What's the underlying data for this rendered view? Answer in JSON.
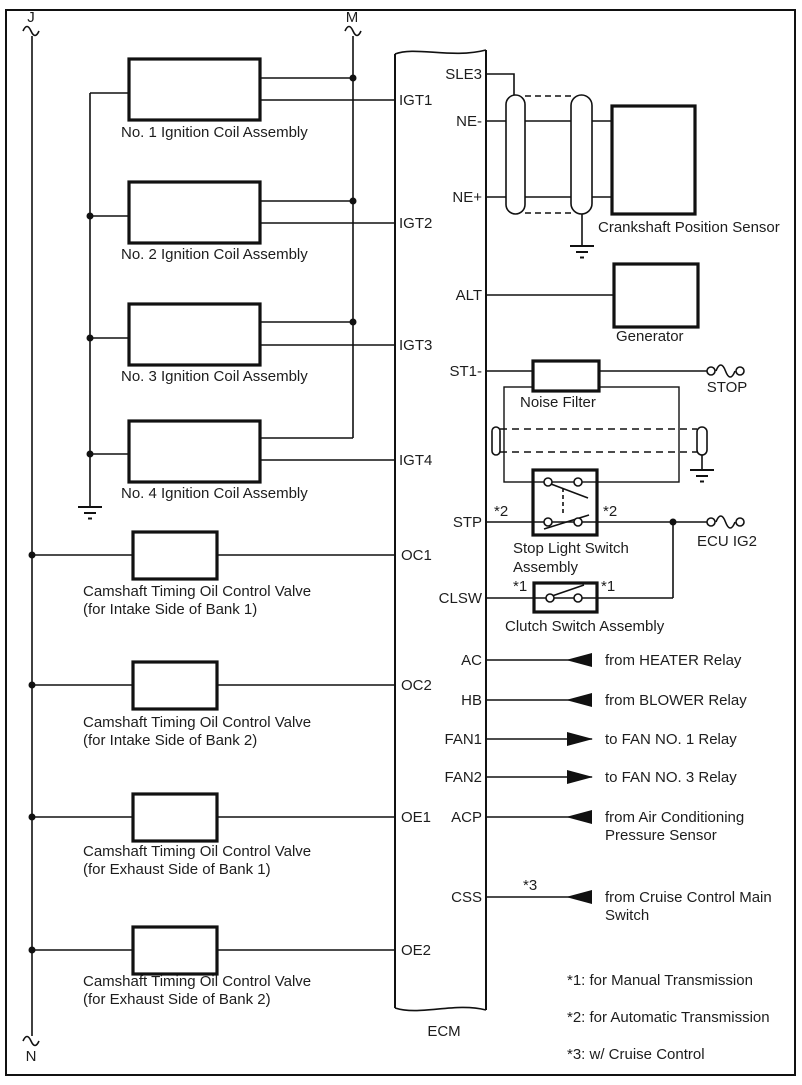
{
  "connectors": {
    "j": "J",
    "m": "M",
    "n": "N",
    "stop": "STOP",
    "ecu_ig2": "ECU IG2"
  },
  "ecm": {
    "label": "ECM",
    "right_pins": {
      "sle3": "SLE3",
      "ne_minus": "NE-",
      "ne_plus": "NE+",
      "alt": "ALT",
      "st1_minus": "ST1-",
      "stp": "STP",
      "clsw": "CLSW",
      "ac": "AC",
      "hb": "HB",
      "fan1": "FAN1",
      "fan2": "FAN2",
      "acp": "ACP",
      "css": "CSS"
    },
    "left_pins": {
      "igt1": "IGT1",
      "igt2": "IGT2",
      "igt3": "IGT3",
      "igt4": "IGT4",
      "oc1": "OC1",
      "oc2": "OC2",
      "oe1": "OE1",
      "oe2": "OE2"
    }
  },
  "devices": {
    "coil1": "No. 1 Ignition Coil Assembly",
    "coil2": "No. 2 Ignition Coil Assembly",
    "coil3": "No. 3 Ignition Coil Assembly",
    "coil4": "No. 4 Ignition Coil Assembly",
    "valve_line1": "Camshaft Timing Oil Control Valve",
    "valve1_line2": "(for Intake Side of Bank 1)",
    "valve2_line2": "(for Intake Side of Bank 2)",
    "valve3_line2": "(for Exhaust Side of Bank 1)",
    "valve4_line2": "(for Exhaust Side of Bank 2)",
    "crank_sensor": "Crankshaft Position Sensor",
    "generator": "Generator",
    "noise_filter": "Noise Filter",
    "stop_light_switch_line1": "Stop Light Switch",
    "stop_light_switch_line2": "Assembly",
    "clutch_switch": "Clutch Switch Assembly"
  },
  "flags": {
    "star1": "*1",
    "star2": "*2",
    "star3": "*3"
  },
  "external": {
    "heater": "from HEATER Relay",
    "blower": "from BLOWER Relay",
    "fan1": "to FAN NO. 1 Relay",
    "fan2": "to FAN NO. 3 Relay",
    "acp_line1": "from Air Conditioning",
    "acp_line2": "Pressure Sensor",
    "css_line1": "from Cruise Control Main",
    "css_line2": "Switch"
  },
  "notes": {
    "n1": "*1: for Manual Transmission",
    "n2": "*2: for Automatic Transmission",
    "n3": "*3: w/ Cruise Control"
  }
}
